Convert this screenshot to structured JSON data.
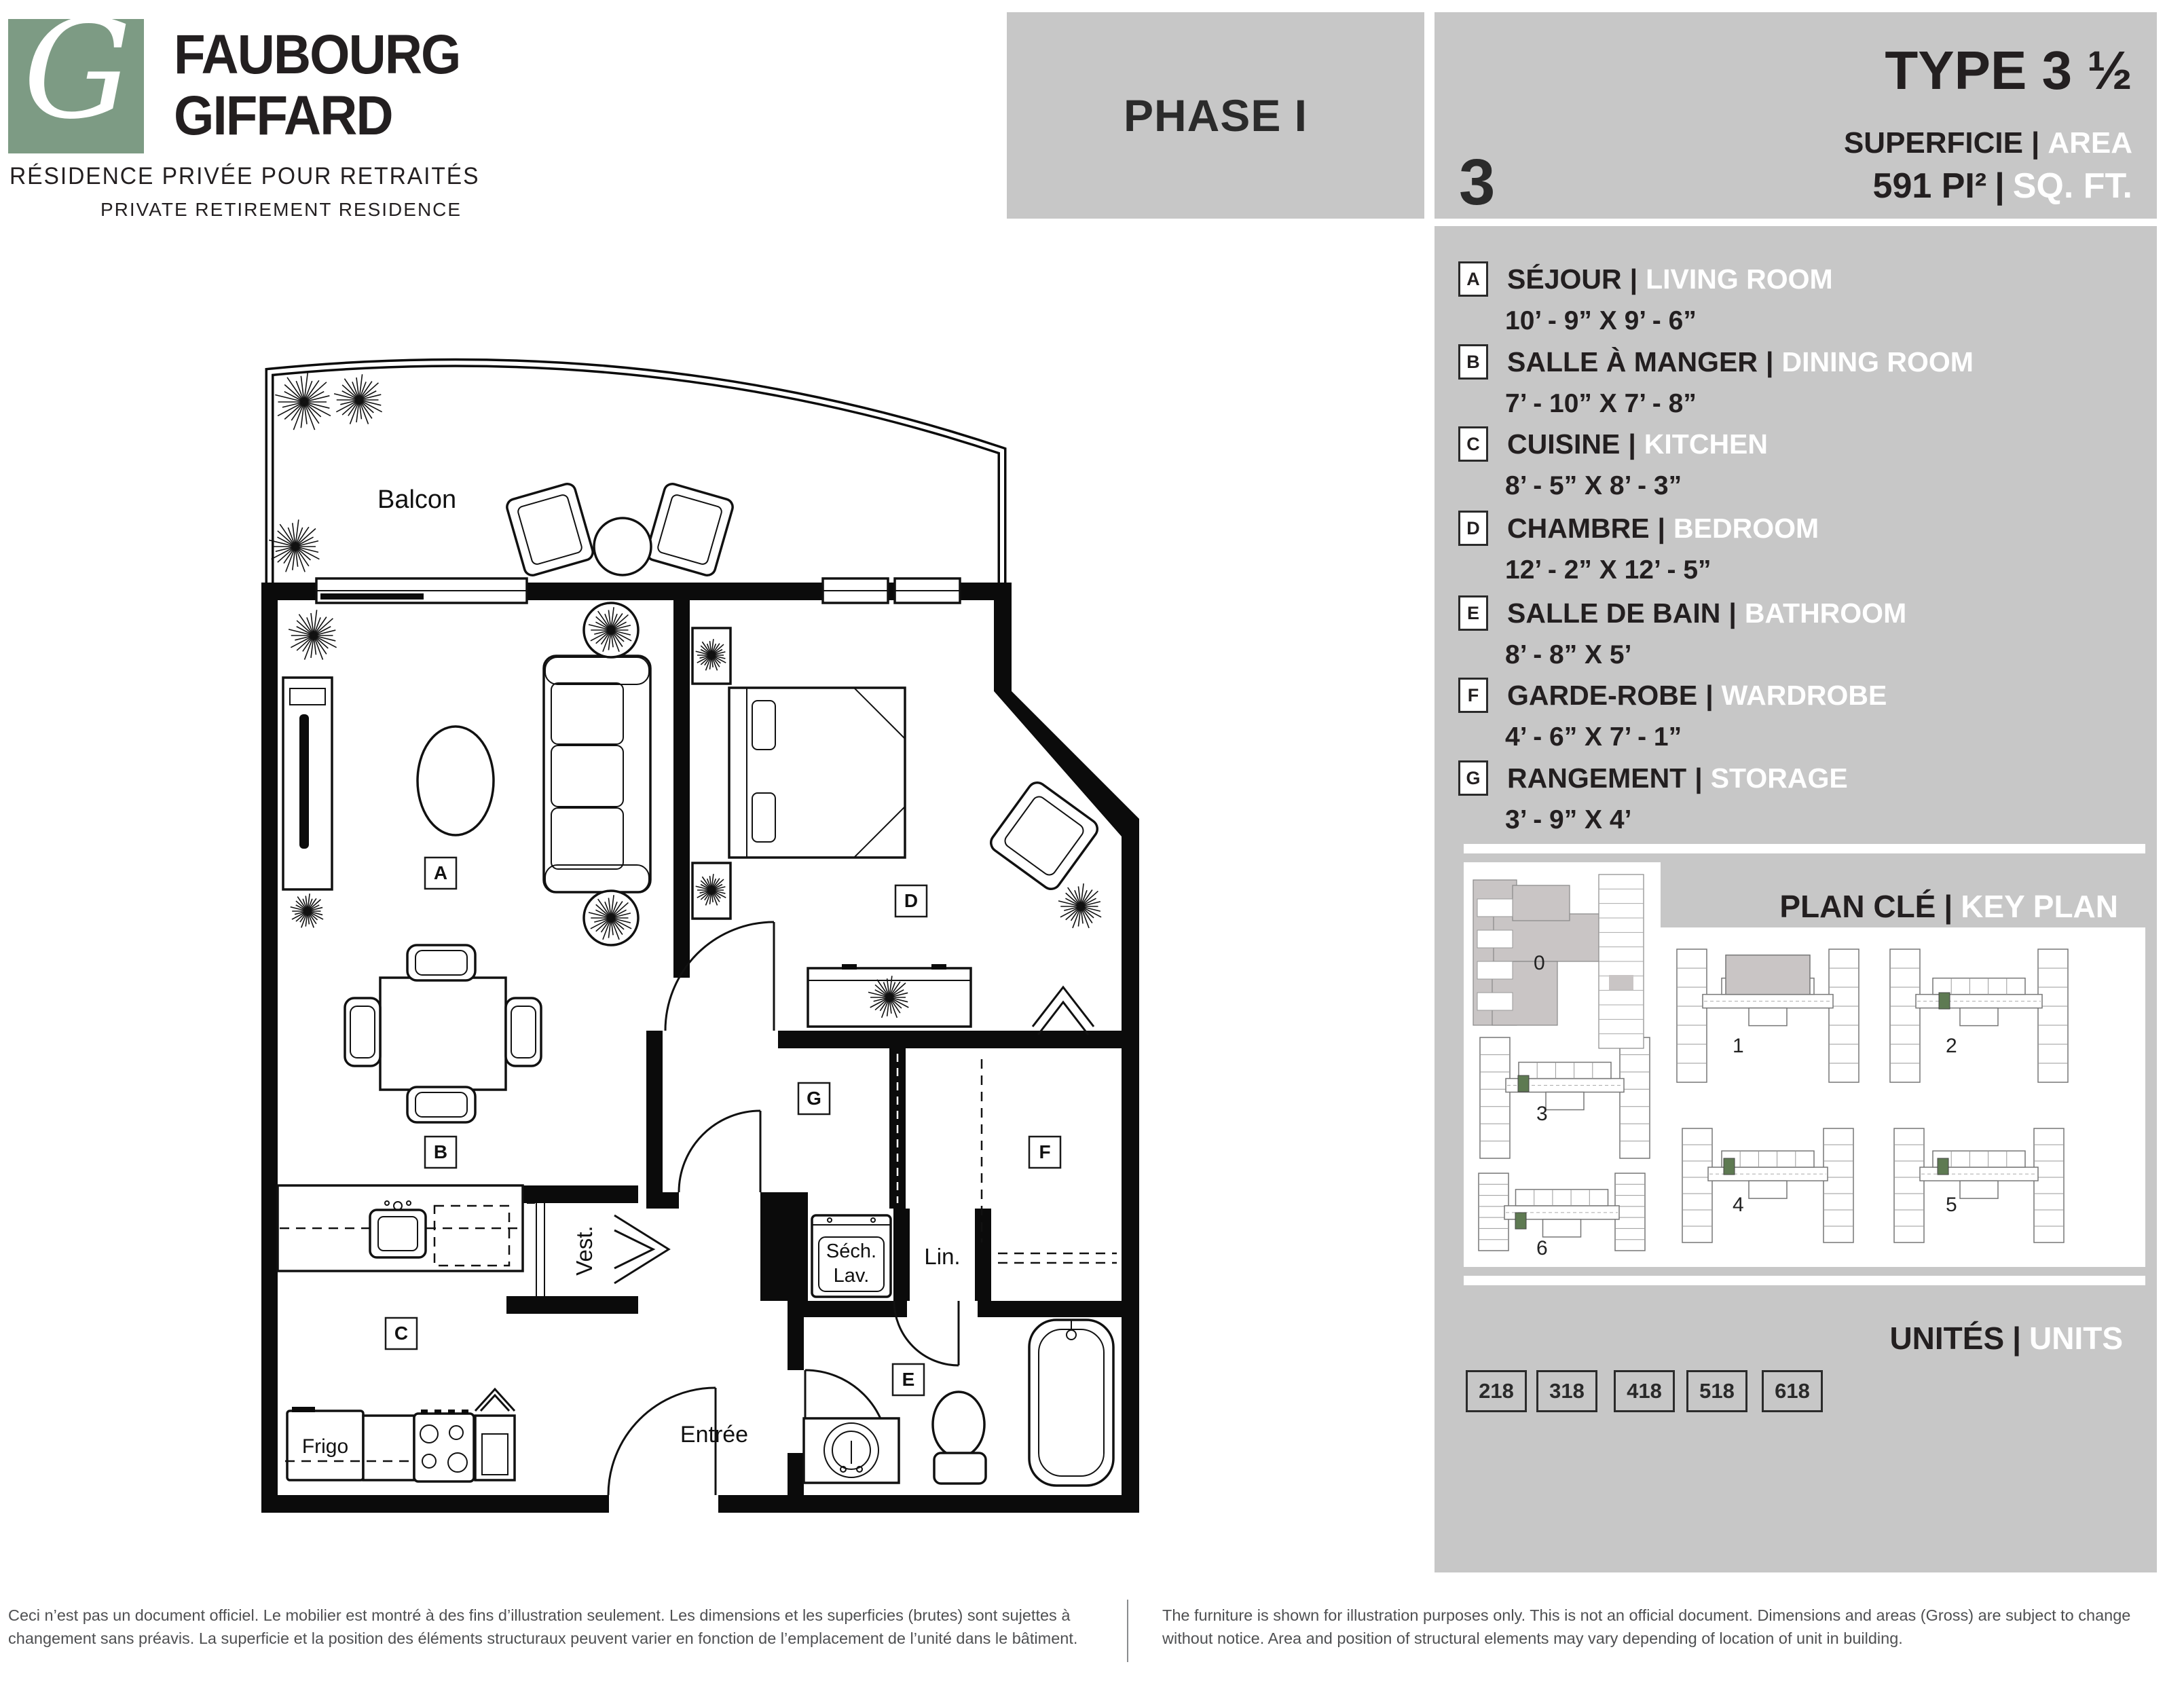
{
  "misc": {
    "sep": "|"
  },
  "brand": {
    "logo_letter": "G",
    "line1": "FAUBOURG",
    "line2": "GIFFARD",
    "subtitle_fr": "RÉSIDENCE PRIVÉE POUR RETRAITÉS",
    "subtitle_en": "PRIVATE RETIREMENT RESIDENCE"
  },
  "header": {
    "phase": "PHASE I",
    "big_number": "3",
    "type_label": "TYPE 3 ½",
    "area_label_fr": "SUPERFICIE",
    "area_label_en": "AREA",
    "area_value_fr": "591 PI²",
    "area_value_en": "SQ. FT."
  },
  "legend": {
    "items": [
      {
        "letter": "A",
        "name_fr": "SÉJOUR",
        "name_en": "LIVING ROOM",
        "dimensions": "10’ - 9” X 9’ - 6”"
      },
      {
        "letter": "B",
        "name_fr": "SALLE À MANGER",
        "name_en": "DINING ROOM",
        "dimensions": "7’ - 10” X 7’ - 8”"
      },
      {
        "letter": "C",
        "name_fr": "CUISINE",
        "name_en": "KITCHEN",
        "dimensions": "8’ - 5” X 8’ - 3”"
      },
      {
        "letter": "D",
        "name_fr": "CHAMBRE",
        "name_en": "BEDROOM",
        "dimensions": "12’ - 2” X 12’ - 5”"
      },
      {
        "letter": "E",
        "name_fr": "SALLE DE BAIN",
        "name_en": "BATHROOM",
        "dimensions": "8’ - 8” X 5’"
      },
      {
        "letter": "F",
        "name_fr": "GARDE-ROBE",
        "name_en": "WARDROBE",
        "dimensions": "4’ - 6” X 7’ - 1”"
      },
      {
        "letter": "G",
        "name_fr": "RANGEMENT",
        "name_en": "STORAGE",
        "dimensions": "3’ - 9” X 4’"
      }
    ]
  },
  "key_plan": {
    "title_fr": "PLAN CLÉ",
    "title_en": "KEY PLAN",
    "building_labels": [
      "0",
      "1",
      "2",
      "3",
      "4",
      "5",
      "6"
    ]
  },
  "units": {
    "title_fr": "UNITÉS",
    "title_en": "UNITS",
    "numbers": [
      "218",
      "318",
      "418",
      "518",
      "618"
    ]
  },
  "floor_plan": {
    "room_letters": [
      "A",
      "B",
      "C",
      "D",
      "E",
      "F",
      "G"
    ],
    "labels": {
      "balcony": "Balcon",
      "fridge": "Frigo",
      "vestibule": "Vest.",
      "laundry_line1": "Séch.",
      "laundry_line2": "Lav.",
      "linen": "Lin.",
      "entrance": "Entrée"
    }
  },
  "disclaimer": {
    "fr": "Ceci n’est pas un document officiel. Le mobilier est montré à des fins d’illustration seulement. Les dimensions et les superficies (brutes) sont sujettes à changement sans préavis. La superficie et la position des éléments structuraux peuvent varier en fonction de l’emplacement de l’unité dans le bâtiment.",
    "en": "The furniture is shown for illustration purposes only. This is not an official document. Dimensions and areas (Gross) are subject to change without notice. Area and position of structural elements may vary depending of location of unit in building."
  },
  "colors": {
    "panel_gray": "#c7c7c7",
    "ink": "#231f20",
    "white": "#ffffff",
    "logo_green": "#7d9b84",
    "unit_green": "#5e7a52"
  }
}
